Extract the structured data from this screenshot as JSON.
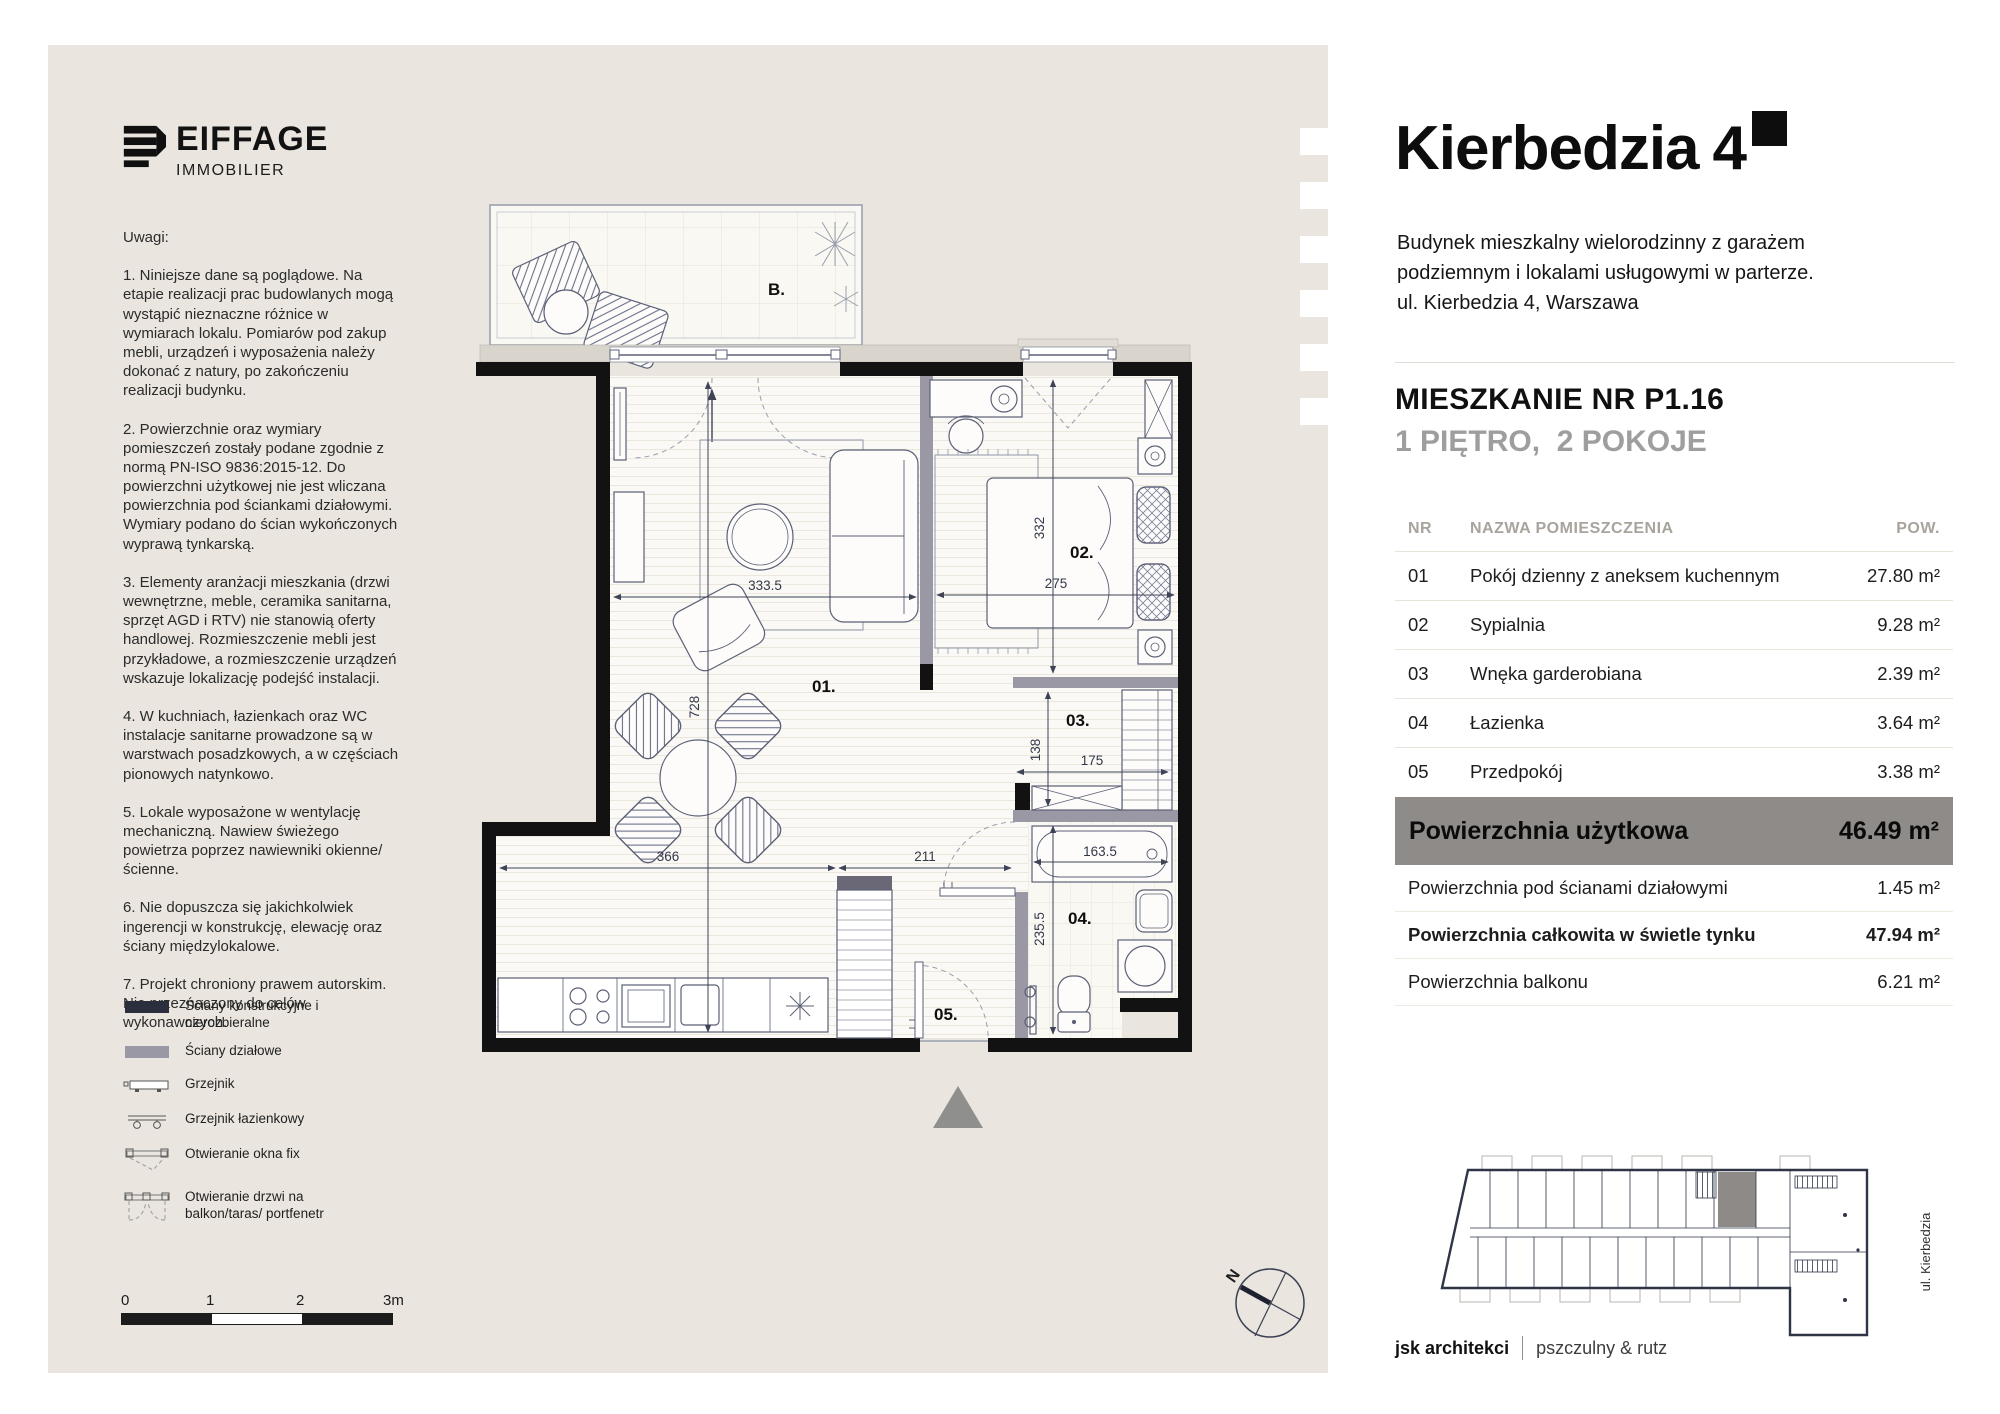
{
  "brand": {
    "name": "EIFFAGE",
    "division": "IMMOBILIER"
  },
  "notes": {
    "heading": "Uwagi:",
    "items": [
      "1. Niniejsze dane są poglądowe. Na etapie realizacji prac budowlanych mogą wystąpić nieznaczne różnice w wymiarach lokalu. Pomiarów pod zakup mebli, urządzeń i wyposażenia należy dokonać z natury, po zakończeniu realizacji budynku.",
      "2. Powierzchnie oraz wymiary pomieszczeń zostały podane zgodnie z normą PN-ISO 9836:2015-12. Do powierzchni użytkowej nie jest wliczana powierzchnia pod ściankami działowymi. Wymiary podano do ścian wykończonych wyprawą tynkarską.",
      "3. Elementy aranżacji mieszkania (drzwi wewnętrzne, meble, ceramika sanitarna, sprzęt AGD i RTV) nie stanowią oferty handlowej. Rozmieszczenie mebli jest przykładowe, a rozmieszczenie urządzeń wskazuje lokalizację podejść instalacji.",
      "4. W kuchniach, łazienkach oraz WC instalacje sanitarne prowadzone są w warstwach posadzkowych, a w częściach pionowych natynkowo.",
      "5. Lokale wyposażone w wentylację mechaniczną. Nawiew świeżego powietrza poprzez nawiewniki okienne/ścienne.",
      "6. Nie dopuszcza się jakichkolwiek ingerencji w konstrukcję, elewację oraz ściany międzylokalowe.",
      "7. Projekt chroniony prawem autorskim. Nie przeznaczony do celów wykonawczych."
    ]
  },
  "legend": {
    "items": [
      {
        "label": "Ściany konstrukcyjne i nierozbieralne"
      },
      {
        "label": "Ściany działowe"
      },
      {
        "label": "Grzejnik"
      },
      {
        "label": "Grzejnik łazienkowy"
      },
      {
        "label": "Otwieranie okna fix"
      },
      {
        "label": "Otwieranie drzwi na balkon/taras/ portfenetr"
      }
    ]
  },
  "scalebar": {
    "t0": "0",
    "t1": "1",
    "t2": "2",
    "t3": "3m"
  },
  "plan": {
    "labels": {
      "balcony": "B.",
      "living": "01.",
      "bedroom": "02.",
      "wardrobe": "03.",
      "bathroom": "04.",
      "hall": "05."
    },
    "dims": {
      "living_w": "333.5",
      "living_h": "728",
      "bedroom_h": "332",
      "bedroom_w": "275",
      "wardrobe_h": "138",
      "wardrobe_w": "175",
      "kitchen_w": "366",
      "hall_w": "211",
      "bath_w": "163.5",
      "bath_h": "235.5"
    },
    "compass_n": "N"
  },
  "header": {
    "title": "Kierbedzia",
    "title_number": "4",
    "subtitle_lines": [
      "Budynek mieszkalny wielorodzinny z garażem",
      "podziemnym i lokalami usługowymi w parterze.",
      "ul. Kierbedzia 4, Warszawa"
    ],
    "apartment": "MIESZKANIE NR P1.16",
    "floor_rooms": "1 PIĘTRO,  2 POKOJE"
  },
  "rooms_table": {
    "col_nr": "NR",
    "col_name": "NAZWA POMIESZCZENIA",
    "col_area": "POW.",
    "rows": [
      {
        "nr": "01",
        "name": "Pokój dzienny z aneksem kuchennym",
        "area": "27.80 m²"
      },
      {
        "nr": "02",
        "name": "Sypialnia",
        "area": "9.28 m²"
      },
      {
        "nr": "03",
        "name": "Wnęka garderobiana",
        "area": "2.39 m²"
      },
      {
        "nr": "04",
        "name": "Łazienka",
        "area": "3.64 m²"
      },
      {
        "nr": "05",
        "name": "Przedpokój",
        "area": "3.38 m²"
      }
    ],
    "total_label": "Powierzchnia użytkowa",
    "total_value": "46.49 m²",
    "extra_rows": [
      {
        "label": "Powierzchnia pod ścianami działowymi",
        "value": "1.45 m²"
      },
      {
        "label": "Powierzchnia całkowita w świetle tynku",
        "value": "47.94 m²"
      },
      {
        "label": "Powierzchnia balkonu",
        "value": "6.21 m²"
      }
    ]
  },
  "keyplan": {
    "street": "ul. Kierbedzia"
  },
  "footer": {
    "studio": "jsk architekci",
    "partners": "pszczulny & rutz"
  }
}
